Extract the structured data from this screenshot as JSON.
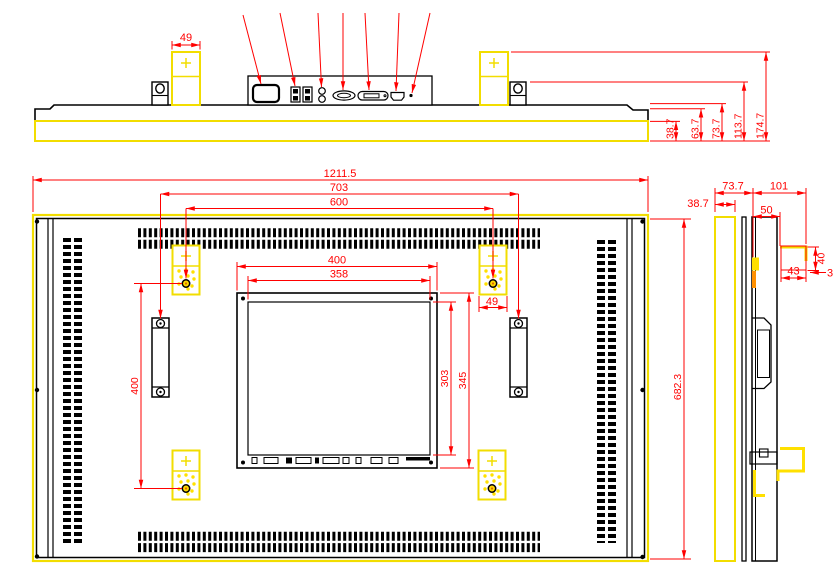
{
  "drawing": {
    "title": "flat-panel-display-mechanical-drawing",
    "colors": {
      "outline": "#000000",
      "dimension": "#ff0000",
      "highlight": "#f2dd00",
      "background": "#ffffff"
    },
    "icons": [
      "power-inlet-icon",
      "usb-port-icon",
      "audio-jack-icon",
      "vga-port-icon",
      "dvi-port-icon",
      "hdmi-port-icon",
      "indicator-dot-icon"
    ],
    "dimensions": {
      "top_view": {
        "bracket_width": "49",
        "stack": [
          "38.7",
          "63.7",
          "73.7",
          "113.7",
          "174.7"
        ]
      },
      "front_view": {
        "overall_width": "1211.5",
        "handle_span": "703",
        "vesa_width": "600",
        "panel_width": "400",
        "display_width": "358",
        "display_height": "303",
        "panel_height": "345",
        "vesa_height": "400",
        "bracket_width": "49",
        "overall_height": "682.3"
      },
      "side_view": {
        "chassis_depth": "73.7",
        "mount_depth": "101",
        "bezel_depth": "38.7",
        "mount_offset": "50",
        "hook_width": "43",
        "hook_height": "40",
        "hook_lip": "3"
      }
    }
  }
}
